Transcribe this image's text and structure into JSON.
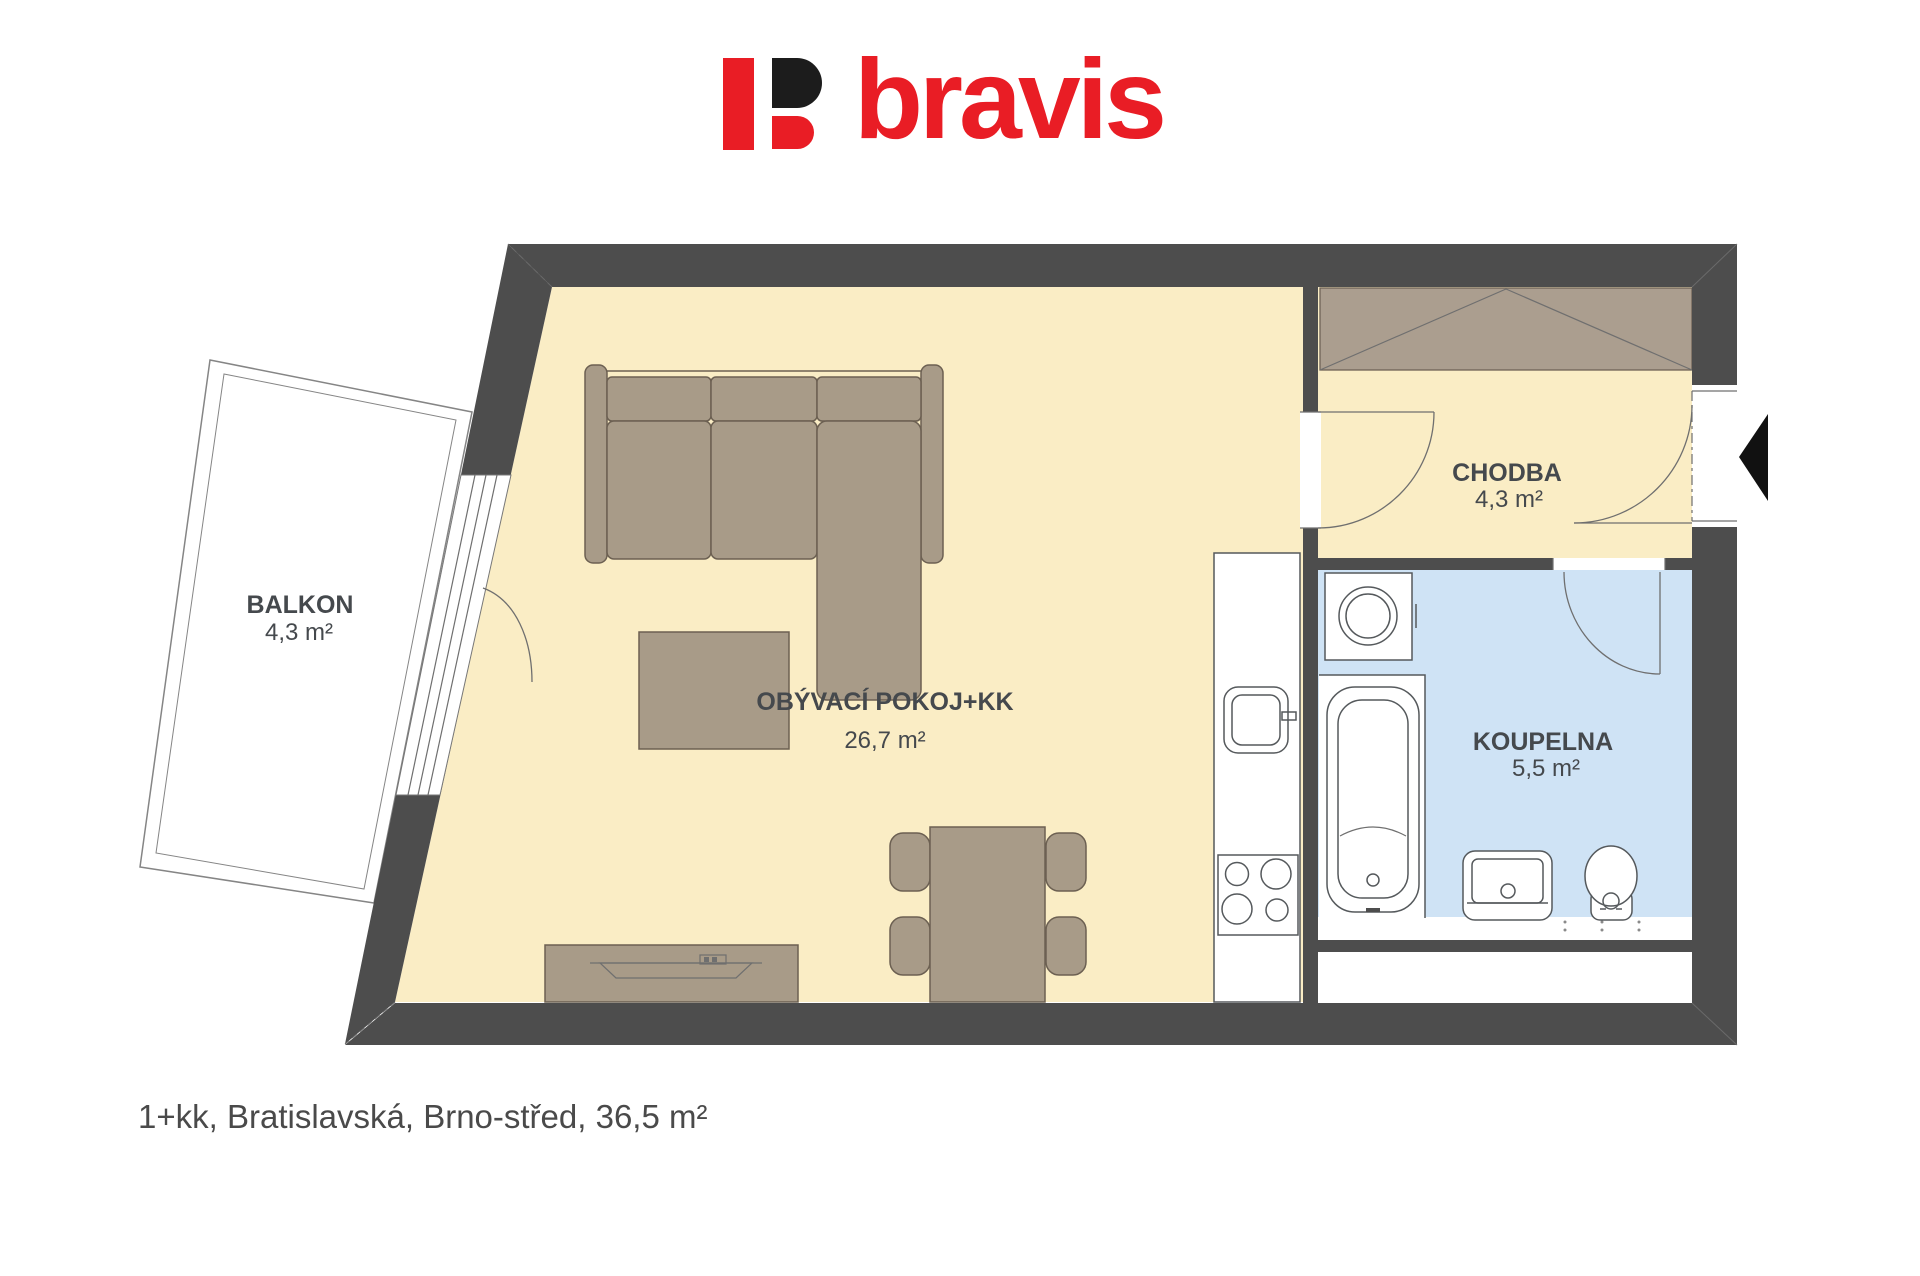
{
  "logo": {
    "brand": "bravis",
    "mark": "B-symbol"
  },
  "caption": "1+kk, Bratislavská, Brno-střed, 36,5 m²",
  "plan": {
    "rooms": [
      {
        "id": "balkon",
        "name": "BALKON",
        "area": "4,3 m²"
      },
      {
        "id": "obyvaci-pokoj",
        "name": "OBÝVACÍ POKOJ+KK",
        "area": "26,7 m²"
      },
      {
        "id": "chodba",
        "name": "CHODBA",
        "area": "4,3 m²"
      },
      {
        "id": "koupelna",
        "name": "KOUPELNA",
        "area": "5,5 m²"
      }
    ],
    "fixtures": [
      "sofa",
      "coffee-table",
      "tv-stand",
      "dining-table",
      "dining-chairs",
      "kitchen-counter",
      "kitchen-sink",
      "stove",
      "washing-machine",
      "bathtub",
      "washbasin",
      "toilet",
      "wardrobe",
      "entrance-arrow"
    ]
  },
  "colors": {
    "wall": "#4d4d4d",
    "floor": "#faedc5",
    "bathroom_floor": "#cfe3f5",
    "furniture": "#a89b88",
    "wardrobe": "#ab9e8f",
    "fixture_line": "#55595c",
    "brand_red": "#e91d25",
    "brand_black": "#1c1c1c",
    "label_text": "#45494d",
    "caption_text": "#4a4a4a"
  }
}
